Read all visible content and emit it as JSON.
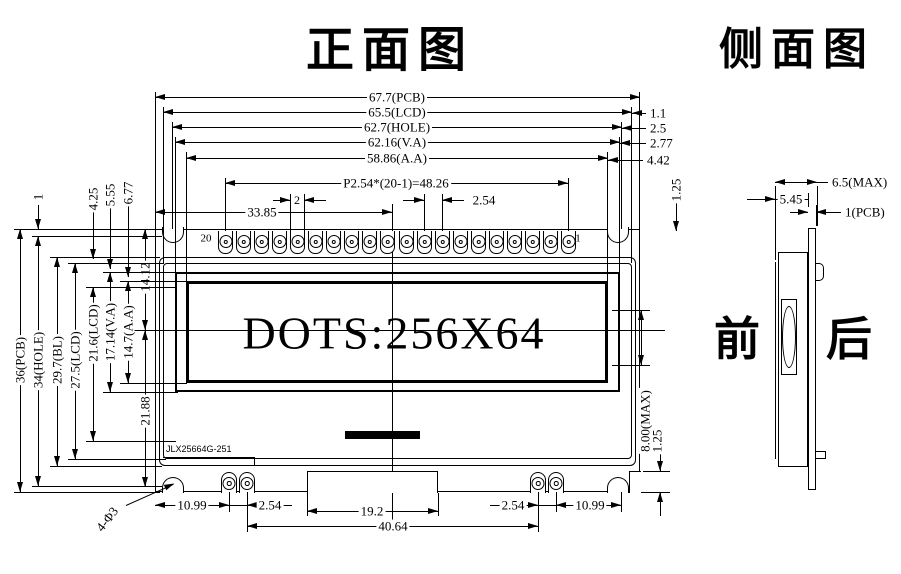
{
  "titles": {
    "front": "正面图",
    "side": "侧面图"
  },
  "front": {
    "display_text": "DOTS:256X64",
    "board_label": "JLX25664G-251",
    "pin_label_left": "20",
    "pin_label_right": "1",
    "dims": {
      "pcb_w": "67.7(PCB)",
      "lcd_w": "65.5(LCD)",
      "hole_w": "62.7(HOLE)",
      "va_w": "62.16(V.A)",
      "aa_w": "58.86(A.A)",
      "pin_row": "P2.54*(20-1)=48.26",
      "pin_w": "2",
      "pin_pitch": "2.54",
      "half_w": "33.85",
      "edge_lcd": "1.1",
      "edge_hole": "2.5",
      "edge_va": "2.77",
      "edge_aa": "4.42",
      "pin_inset": "1.25",
      "pcb_h": "36(PCB)",
      "hole_h": "34(HOLE)",
      "bl_h": "29.7(BL)",
      "lcd_h": "27.5(LCD)",
      "lcd_h2": "21.6(LCD)",
      "va_h": "17.14(V.A)",
      "aa_h": "14.7(A.A)",
      "top_edge": "1",
      "off1": "4.25",
      "off2": "5.55",
      "off3": "6.77",
      "mid1": "14.12",
      "mid2": "21.88",
      "bl_pin_l": "10.99",
      "bl_pitch_l": "2.54",
      "notch_w": "19.2",
      "bl_pitch_r": "2.54",
      "bl_pin_r": "10.99",
      "bl_span": "40.64",
      "mount": "4-Φ3",
      "thick": "8.00(MAX)",
      "lip": "1.25"
    }
  },
  "side": {
    "front_label": "前",
    "back_label": "后",
    "dims": {
      "total": "6.5(MAX)",
      "module": "5.45",
      "pcb": "1(PCB)"
    }
  }
}
